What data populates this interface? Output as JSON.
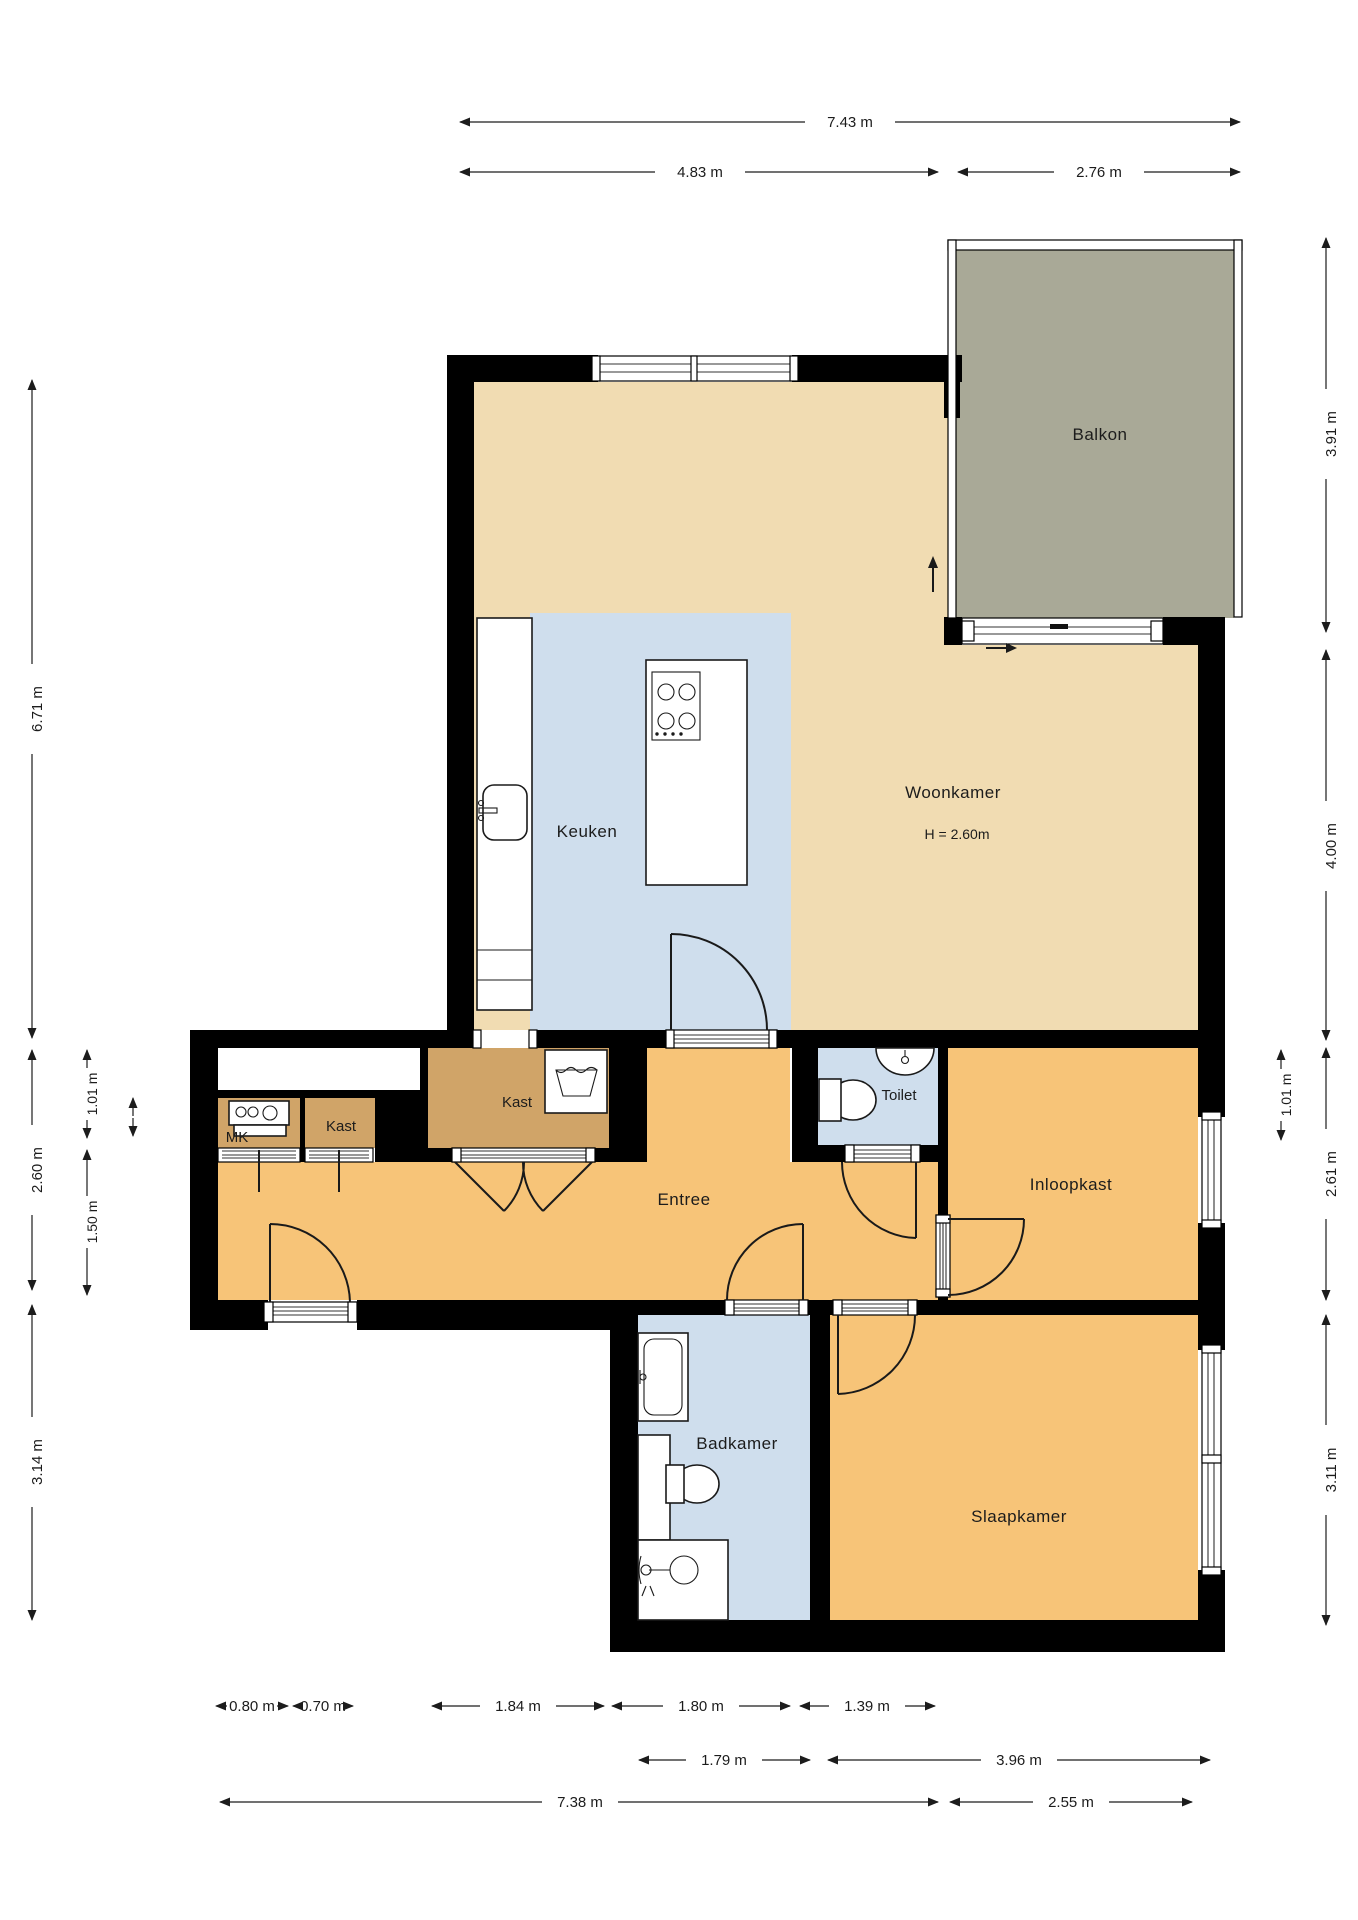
{
  "floorplan": {
    "rooms": {
      "balkon": "Balkon",
      "woonkamer": "Woonkamer",
      "woonkamer_height": "H = 2.60m",
      "keuken": "Keuken",
      "kast_groot": "Kast",
      "mk": "MK",
      "kast_klein": "Kast",
      "entree": "Entree",
      "toilet": "Toilet",
      "inloopkast": "Inloopkast",
      "badkamer": "Badkamer",
      "slaapkamer": "Slaapkamer"
    },
    "dims": {
      "top_total": "7.43 m",
      "top_left": "4.83 m",
      "top_right": "2.76 m",
      "right_balkon": "3.91 m",
      "right_woonkamer": "4.00 m",
      "right_small": "1.01 m",
      "right_inloopkast": "2.61 m",
      "right_slaapkamer": "3.11 m",
      "left_total": "6.71 m",
      "left_entree": "2.60 m",
      "left_badkamer": "3.14 m",
      "left_small": "1.01 m",
      "left_inner": "1.50 m",
      "bottom_mk": "0.80 m",
      "bottom_kast": "0.70 m",
      "bottom_kastdeuren": "1.84 m",
      "bottom_entree_deur": "1.80 m",
      "bottom_toilet": "1.39 m",
      "bottom_badkamer": "1.79 m",
      "bottom_slaapkamer": "3.96 m",
      "bottom_total": "7.38 m",
      "bottom_rechts": "2.55 m"
    },
    "icons": [
      "stove-icon",
      "sink-icon",
      "kitchen-island",
      "washer-icon",
      "meter-cabinet-icon",
      "toilet-icon",
      "basin-icon",
      "bathtub-icon",
      "vanity-icon",
      "shower-icon",
      "drain-icon",
      "direction-arrow-up-icon",
      "direction-arrow-right-icon"
    ],
    "colors": {
      "wall": "#000000",
      "living": "#f1dcb2",
      "hall": "#f7c478",
      "closet": "#d0a468",
      "wet": "#cfdeed",
      "balcony": "#a9a997"
    }
  }
}
